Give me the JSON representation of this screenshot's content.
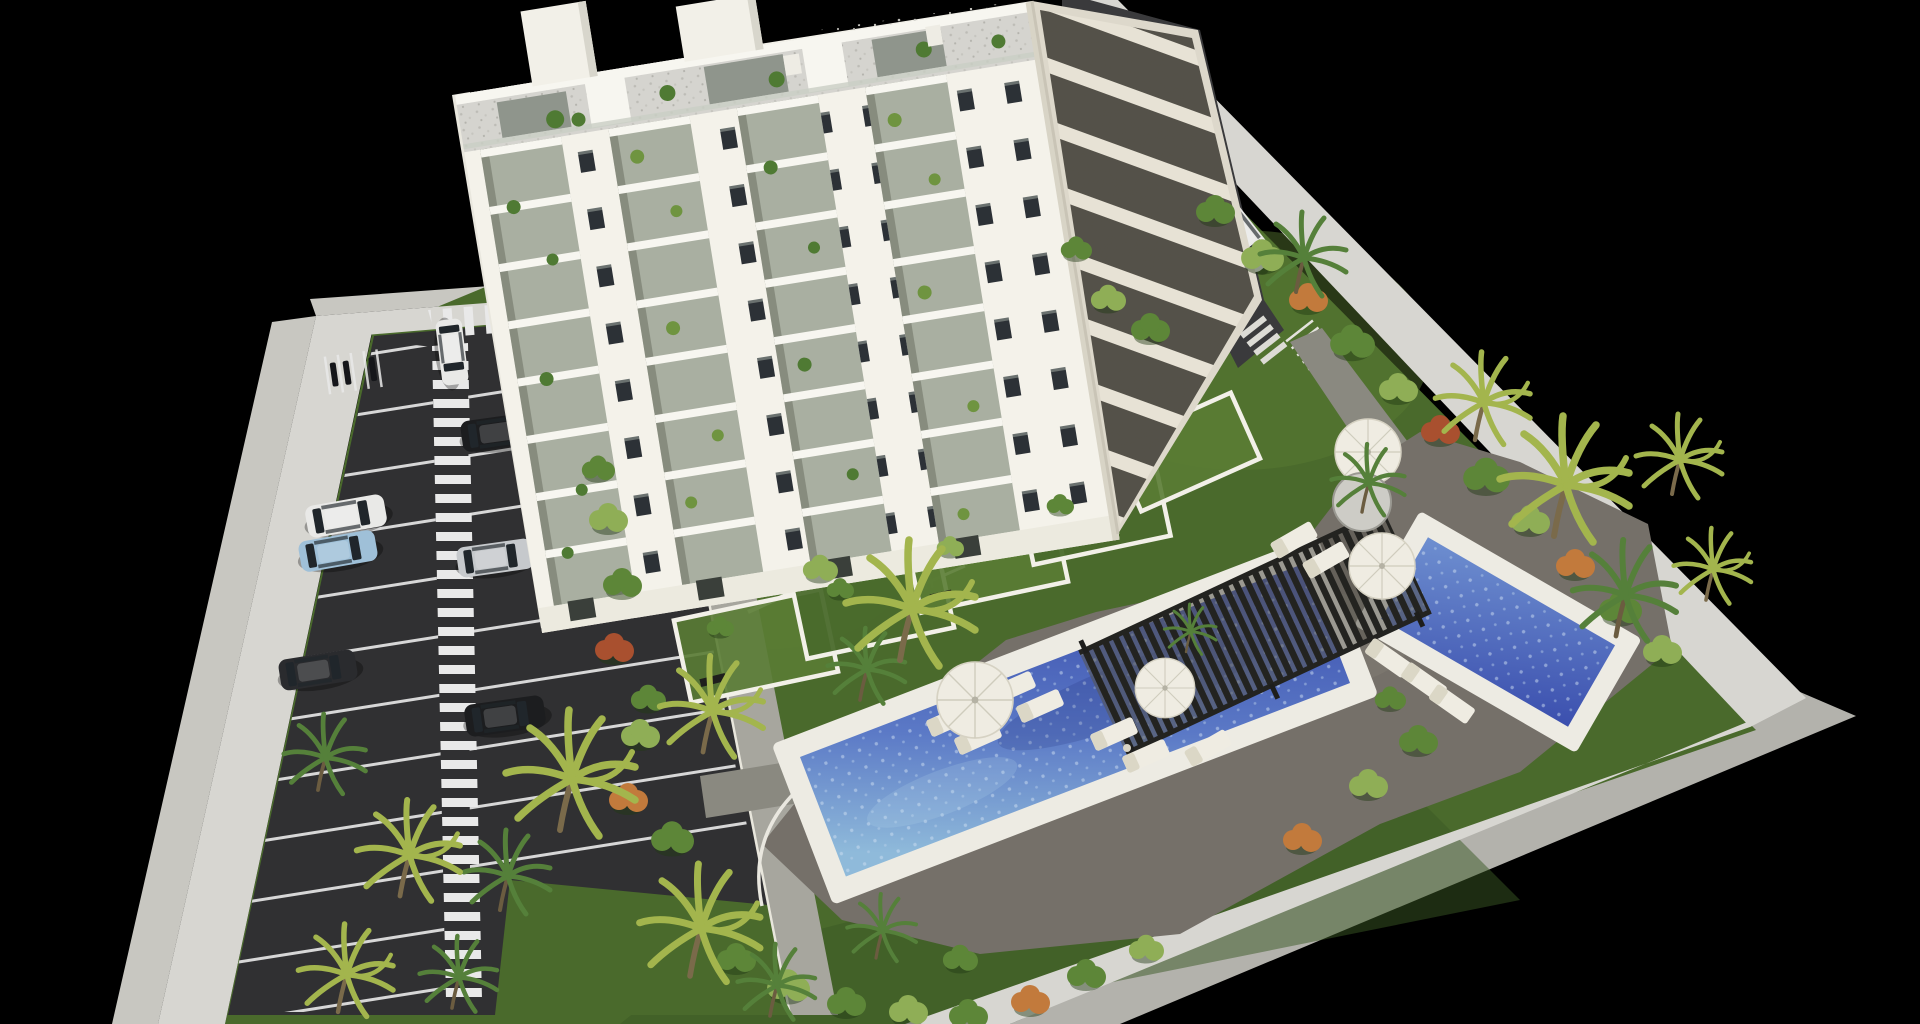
{
  "scene": {
    "type": "3d-architectural-render",
    "description": "Aerial isometric rendering of a white 10-storey apartment building inside a walled plot, with a dark parking lot on the left, landscaped gardens with palm trees, a long rectangular swimming pool, a smaller pool, a dark slatted pergola, sun loungers and parasols, all on a black background",
    "background": "#000000"
  },
  "palette": {
    "background": "#000000",
    "wall_top": "#d7d6d1",
    "wall_face": "#c8c7c1",
    "wall_face_shadow": "#b3b2ac",
    "grass": "#4a6a2c",
    "grass_light": "#5a7c34",
    "grass_dark": "#3a5724",
    "asphalt": "#303032",
    "asphalt_drive": "#3a3a3c",
    "stall_line": "#e9e9e9",
    "sidewalk": "#a7a69e",
    "path": "#8a8980",
    "deck": "#757069",
    "deck_light": "#978f83",
    "pool_rim": "#edebe3",
    "water_light": "#8fbada",
    "water_mid": "#5b79c6",
    "water_deep": "#3b4fae",
    "pergola": "#232320",
    "furniture": "#efece2",
    "building_front": "#f4f2ea",
    "building_side": "#e9e7de",
    "building_right": "#ddd8cb",
    "glass": "#a9afa1",
    "window": "#2c3136",
    "slab": "#f7f6f0",
    "gravel": "#d5d4cf",
    "door": "#3a3f3a",
    "planter": "#cdccc6",
    "trunk": "#7a6a4a",
    "palm_green": "#55803a",
    "palm_yellow": "#a3b54d",
    "bush_green": "#5d8638",
    "bush_light": "#8fae56",
    "bush_flower": "#c27a3c",
    "bush_red": "#a9502f",
    "car_white": "#e9e9e7",
    "car_black": "#1c1d1f",
    "car_blue": "#9fc0d8",
    "car_silver": "#c6c9cc",
    "car_dark": "#2a2b2e"
  },
  "inventory": {
    "building": {
      "visible_floors": 10,
      "balcony_columns": 4,
      "roof_towers": 2,
      "ground_floor_gardens": 5
    },
    "parking": {
      "stall_columns": 2,
      "pedestrian_walkways": 2,
      "cars": [
        "white",
        "black",
        "white",
        "light-blue",
        "silver",
        "dark-grey",
        "black"
      ],
      "moto_stalls": 5
    },
    "driveway": {
      "cars": [
        "white"
      ],
      "crosswalks": 1,
      "bike_racks": 7
    },
    "pools": [
      {
        "name": "main-pool",
        "shape": "long-rectangle"
      },
      {
        "name": "small-pool",
        "shape": "rectangle"
      }
    ],
    "pergolas": 1,
    "parasols": 4,
    "sun_loungers": 12,
    "palm_trees": 18,
    "round_planters": 1
  }
}
